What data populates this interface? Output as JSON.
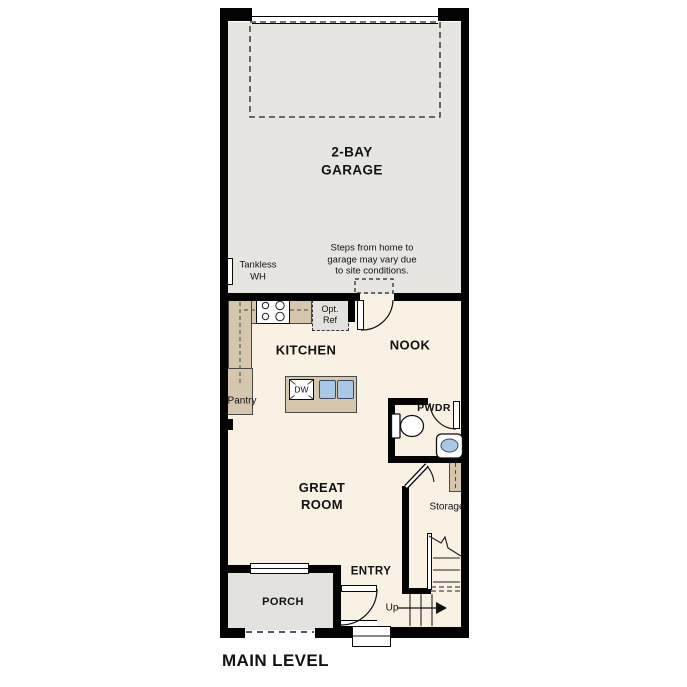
{
  "plan_title": "MAIN LEVEL",
  "colors": {
    "wall": "#030303",
    "garage_floor": "#e6e5e2",
    "living_floor": "#f8f1e4",
    "porch_floor": "#e3e2de",
    "counter_tan": "#d4c7ad",
    "sink_blue": "#a9c8e6"
  },
  "rooms": {
    "garage": {
      "label": "2-BAY\nGARAGE",
      "water_heater_label": "Tankless\nWH",
      "note": "Steps from home to\ngarage may vary due\nto site conditions."
    },
    "kitchen": {
      "label": "KITCHEN",
      "pantry_label": "Pantry",
      "dishwasher_label": "DW",
      "opt_ref_label": "Opt.\nRef"
    },
    "nook": {
      "label": "NOOK"
    },
    "powder": {
      "label": "PWDR"
    },
    "storage": {
      "label": "Storage"
    },
    "great_room": {
      "label": "GREAT\nROOM"
    },
    "entry": {
      "label": "ENTRY",
      "stairs_direction": "Up"
    },
    "porch": {
      "label": "PORCH"
    }
  }
}
